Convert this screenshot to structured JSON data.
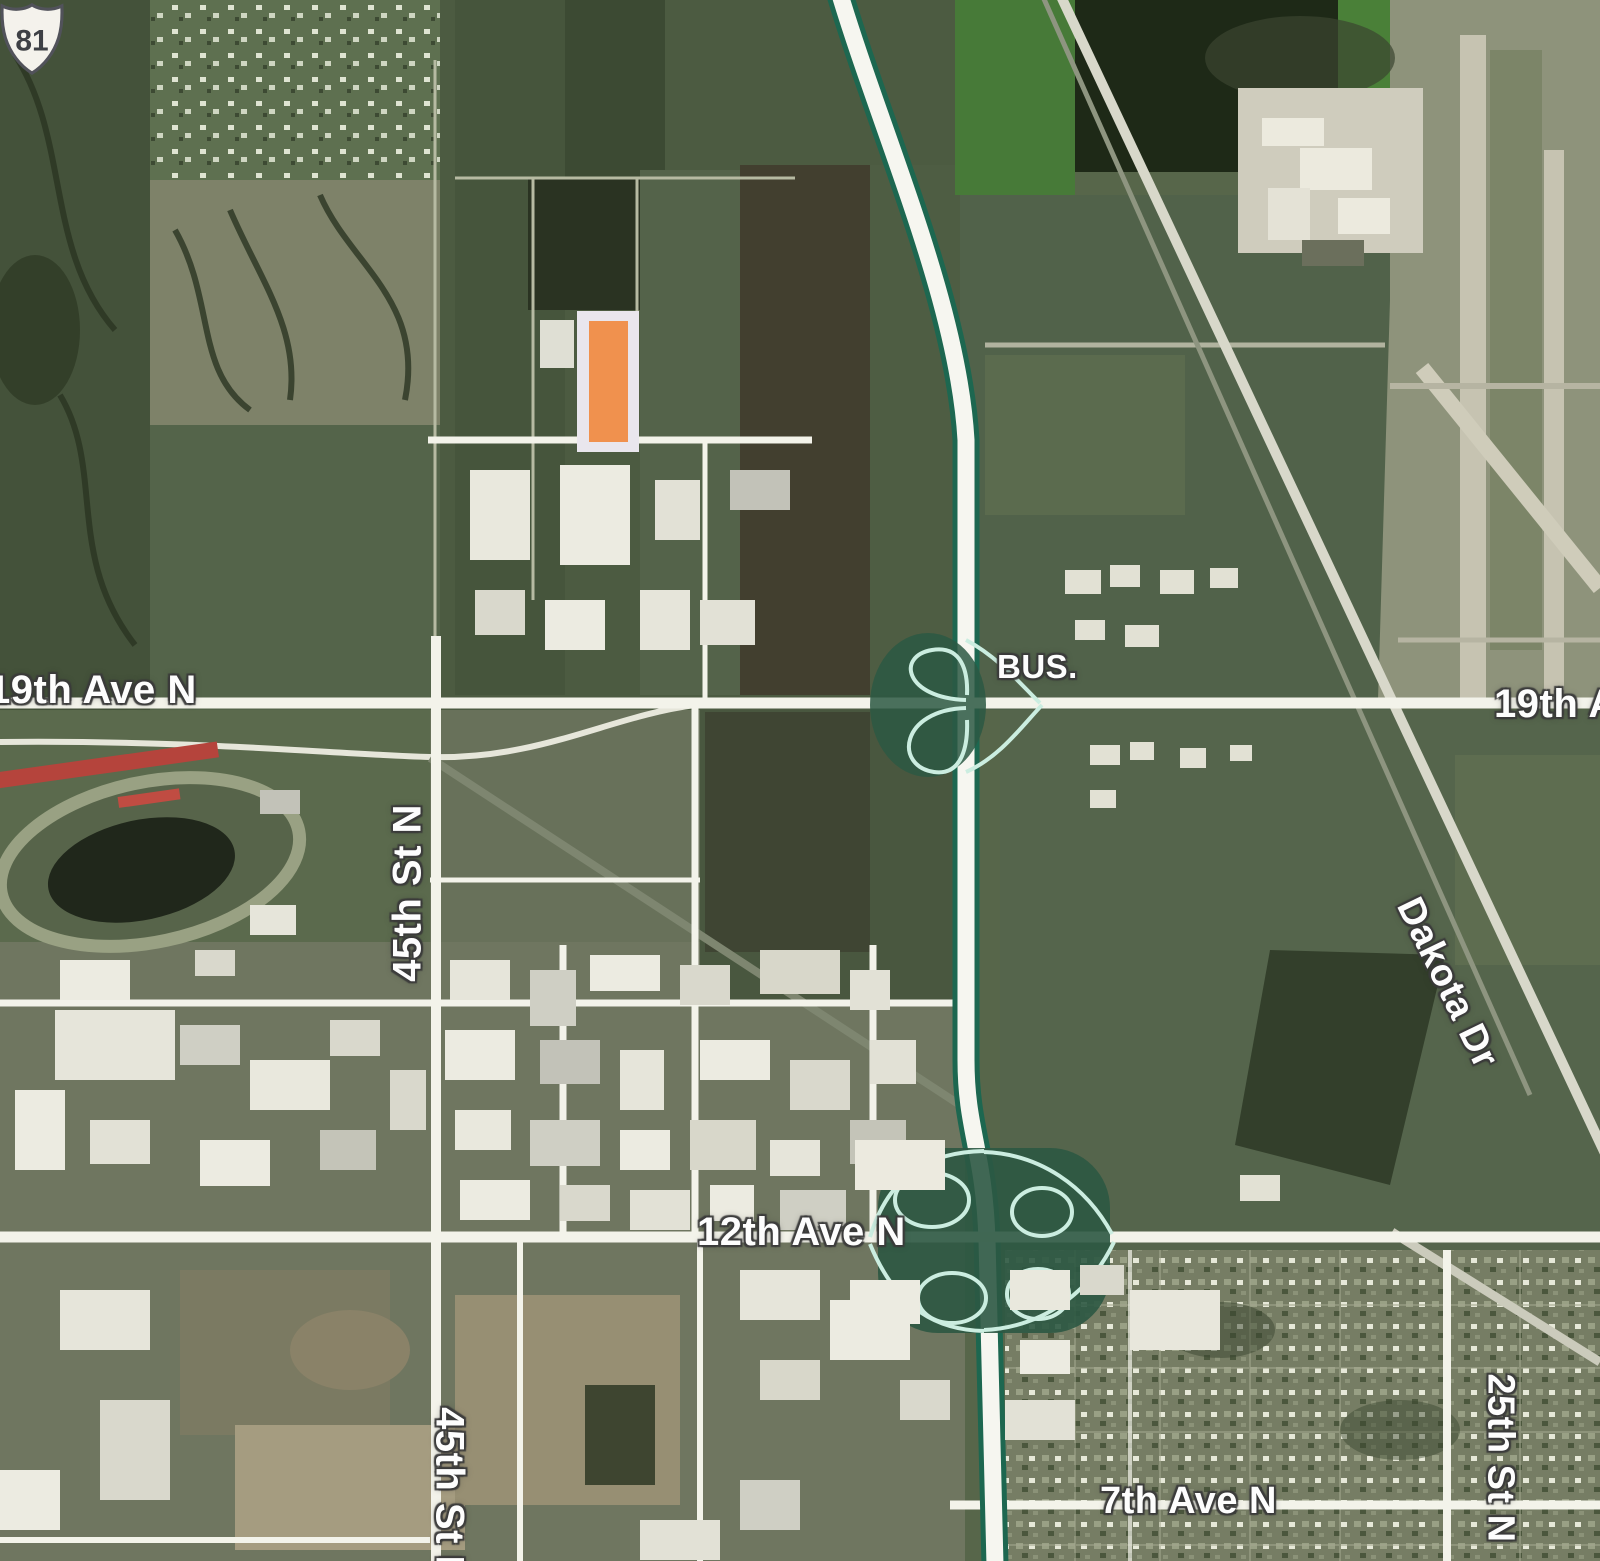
{
  "map": {
    "road_labels": {
      "ave19_west": "19th Ave N",
      "ave19_east": "19th Ave N",
      "st45_north": "45th St N",
      "st45_south": "45th St N",
      "ave12": "12th Ave N",
      "ave7": "7th Ave N",
      "st25": "25th St N",
      "dakota_dr": "Dakota Dr"
    },
    "route_shield": {
      "banner": "BUS.",
      "number": "81"
    },
    "marker": {
      "fill_color": "#F0914E",
      "border_color": "#E9E6ED"
    },
    "colors": {
      "freeway_edge": "#1D6750",
      "road_white": "#F3F3EA",
      "ramp_teal": "#CBEDE0"
    }
  }
}
